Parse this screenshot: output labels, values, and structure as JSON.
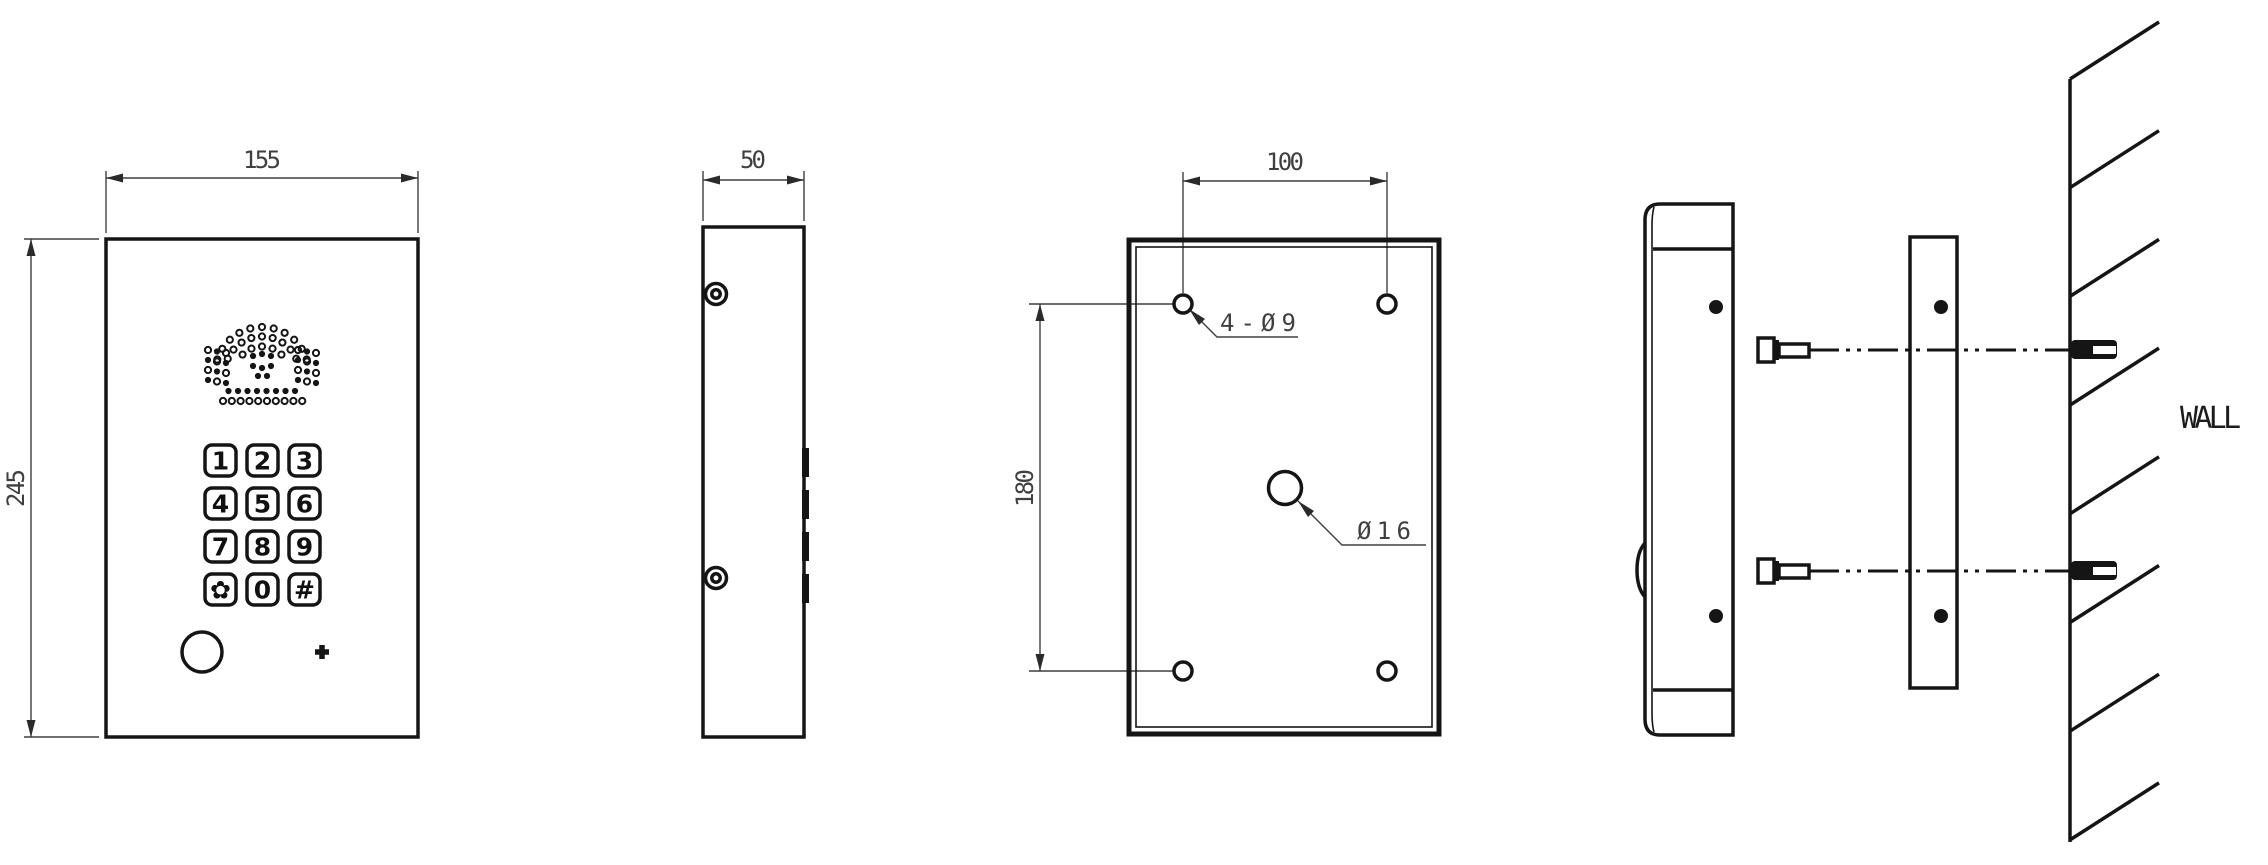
{
  "drawing_title": "Door phone panel installation drawing",
  "views": {
    "front": {
      "dim_width": "155",
      "dim_height": "245",
      "keypad_keys": [
        "1",
        "2",
        "3",
        "4",
        "5",
        "6",
        "7",
        "8",
        "9",
        "✿",
        "0",
        "#"
      ]
    },
    "side": {
      "dim_depth": "50"
    },
    "back": {
      "dim_hole_spacing_horizontal": "100",
      "dim_hole_spacing_vertical": "180",
      "corner_holes_label": "4-Ø9",
      "center_hole_label": "Ø16"
    },
    "install": {
      "wall_label": "WALL"
    }
  },
  "colors": {
    "line": "#151515",
    "dimension": "#3f3f3f",
    "background": "#ffffff"
  }
}
